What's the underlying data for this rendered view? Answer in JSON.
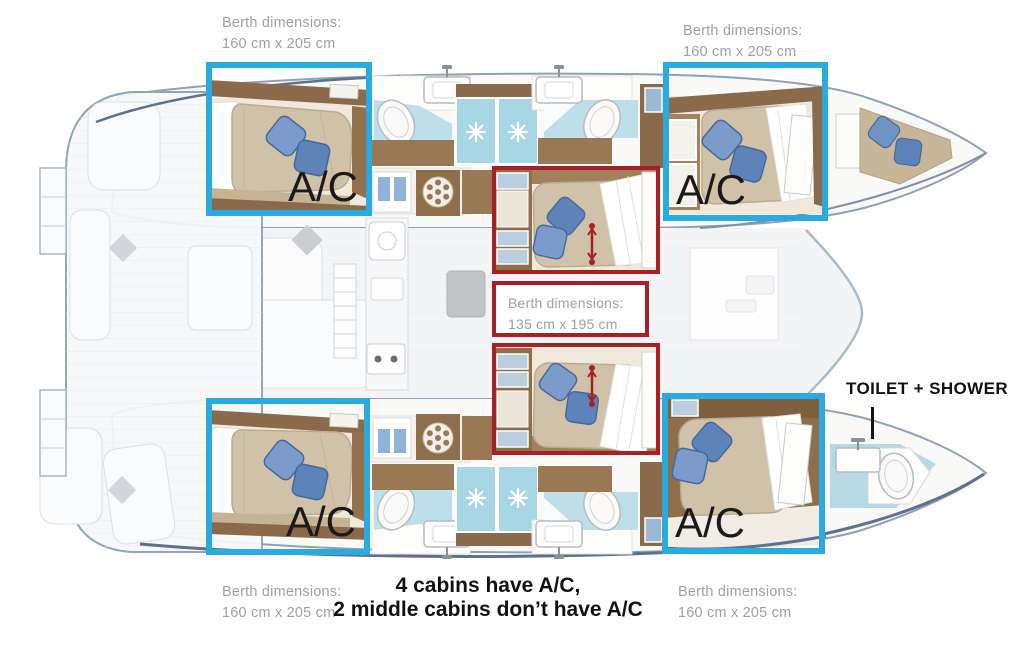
{
  "diagram": {
    "type": "catamaran-floorplan",
    "annotations": {
      "ac_label": "A/C",
      "berth_standard": {
        "line1": "Berth dimensions:",
        "line2": "160 cm x 205 cm"
      },
      "berth_middle": {
        "line1": "Berth dimensions:",
        "line2": "135 cm x 195 cm"
      },
      "toilet_shower_label": "TOILET + SHOWER",
      "note": {
        "line1": "4 cabins have A/C,",
        "line2": "2 middle cabins don’t have A/C"
      }
    },
    "colors": {
      "highlight_blue": "#29abe2",
      "highlight_red": "#a81f24",
      "label_gray": "#9ba1a7",
      "text_black": "#111111",
      "bathroom_blue": "#bcdfe9",
      "shower_blue": "#a7d6e4",
      "wood_brown": "#9a7853",
      "mattress_tan": "#cfc2a8",
      "pillow_blue": "#7b9ccb"
    }
  }
}
